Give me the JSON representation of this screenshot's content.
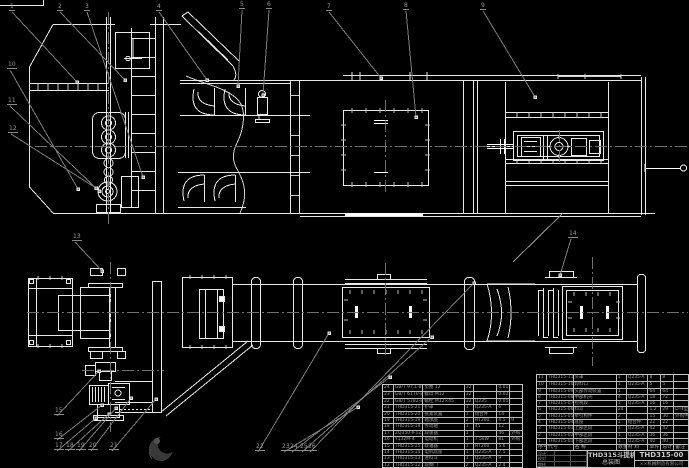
{
  "title_block": {
    "model": "THD315斗提机",
    "sheet_title": "总装图",
    "drawing_number": "THD315-00",
    "company": "××机械制造有限公司",
    "signature_labels": [
      "设计",
      "",
      "",
      "校对",
      "",
      "",
      "审核",
      "",
      ""
    ]
  },
  "colors": {
    "background": "#000000",
    "line": "#e8e8e8",
    "centerline": "#707070",
    "leader": "#7d7d7d",
    "table_text": "#a0a0a0"
  },
  "bom_right": {
    "headers": [
      "序号",
      "代号",
      "名 称",
      "数量",
      "材 料",
      "单件",
      "总计",
      "备注"
    ],
    "rows": [
      [
        "11",
        "THD315-11",
        "头罩",
        "1",
        "Q235-A",
        "8",
        "8",
        ""
      ],
      [
        "10",
        "THD315-10",
        "卸料口",
        "1",
        "Q235-A",
        "5",
        "5",
        ""
      ],
      [
        "9",
        "THD315-09",
        "头部传动装置",
        "1",
        "",
        "64",
        "64",
        ""
      ],
      [
        "8",
        "THD315-08",
        "中部机壳",
        "4",
        "Q235-A",
        "18",
        "72",
        ""
      ],
      [
        "7",
        "THD315-07",
        "检视段",
        "1",
        "Q235-A",
        "16",
        "16",
        ""
      ],
      [
        "6",
        "THD315-06",
        "料斗",
        "24",
        "",
        "1.2",
        "29",
        "DTⅡ型"
      ],
      [
        "5",
        "THD315-05",
        "牵引构件",
        "2",
        "",
        "15",
        "30",
        "外购件"
      ],
      [
        "4",
        "THD315-04",
        "底座",
        "1",
        "组合件",
        "22",
        "22",
        ""
      ],
      [
        "3",
        "THD315-03",
        "上部区段",
        "1",
        "Q235-A",
        "42",
        "42",
        ""
      ],
      [
        "2",
        "THD315-02",
        "中部区段",
        "1",
        "Q235-A",
        "36",
        "36",
        ""
      ],
      [
        "1",
        "THD315-01",
        "下部区段",
        "1",
        "Q235-A",
        "40",
        "40",
        ""
      ]
    ]
  },
  "bom_left": {
    "rows": [
      [
        "24",
        "GB/T 97.1-85",
        "垫圈 12",
        "32",
        "",
        "0.01",
        ""
      ],
      [
        "23",
        "GB/T 6170-86",
        "螺母 M12",
        "32",
        "",
        "0.02",
        ""
      ],
      [
        "22",
        "GB/T 5782-86",
        "螺栓 M12×45",
        "32",
        "Q235",
        "0.05",
        ""
      ],
      [
        "21",
        "THD315-21",
        "护罩",
        "1",
        "Q235-A",
        "6",
        ""
      ],
      [
        "20",
        "THD315-20",
        "张紧装置",
        "1",
        "组合件",
        "14",
        ""
      ],
      [
        "19",
        "THD315-19",
        "轴承座",
        "2",
        "HT200",
        "4.5",
        "9"
      ],
      [
        "18",
        "THD315-18",
        "传动轴",
        "1",
        "45",
        "12",
        ""
      ],
      [
        "17",
        "ZQ350-Ⅱ-1Z",
        "减速器",
        "1",
        "",
        "46",
        "外购"
      ],
      [
        "16",
        "Y132M-4",
        "电动机",
        "1",
        "7.5kW",
        "81",
        "外购"
      ],
      [
        "15",
        "THD315-15",
        "联轴器",
        "1",
        "HT200",
        "5.6",
        ""
      ],
      [
        "14",
        "THD315-14",
        "电机底座",
        "1",
        "Q235-A",
        "7.5",
        ""
      ],
      [
        "13",
        "THD315-13",
        "进料斗",
        "1",
        "Q235-A",
        "9",
        ""
      ],
      [
        "12",
        "THD315-12",
        "观察门",
        "2",
        "Q235-A",
        "2.4",
        ""
      ]
    ]
  },
  "callouts": [
    {
      "n": "1",
      "x": 9,
      "y": 4,
      "tx": 77,
      "ty": 82
    },
    {
      "n": "2",
      "x": 57,
      "y": 4,
      "tx": 125,
      "ty": 80
    },
    {
      "n": "3",
      "x": 84,
      "y": 4,
      "tx": 143,
      "ty": 177
    },
    {
      "n": "4",
      "x": 156,
      "y": 4,
      "tx": 207,
      "ty": 80
    },
    {
      "n": "5",
      "x": 239,
      "y": 2,
      "tx": 238,
      "ty": 86
    },
    {
      "n": "6",
      "x": 266,
      "y": 2,
      "tx": 263,
      "ty": 95
    },
    {
      "n": "7",
      "x": 326,
      "y": 4,
      "tx": 381,
      "ty": 78
    },
    {
      "n": "8",
      "x": 403,
      "y": 3,
      "tx": 416,
      "ty": 117
    },
    {
      "n": "9",
      "x": 480,
      "y": 3,
      "tx": 535,
      "ty": 97
    },
    {
      "n": "10",
      "x": 7,
      "y": 62,
      "tx": 78,
      "ty": 189
    },
    {
      "n": "11",
      "x": 7,
      "y": 98,
      "tx": 99,
      "ty": 191
    },
    {
      "n": "12",
      "x": 8,
      "y": 126,
      "tx": 96,
      "ty": 188
    },
    {
      "n": "13",
      "x": 72,
      "y": 234,
      "tx": 102,
      "ty": 271
    },
    {
      "n": "14",
      "x": 568,
      "y": 231,
      "tx": 560,
      "ty": 275
    },
    {
      "n": "15",
      "x": 54,
      "y": 408,
      "tx": 99,
      "ty": 371
    },
    {
      "n": "16",
      "x": 54,
      "y": 432,
      "tx": 102,
      "ty": 405
    },
    {
      "n": "17",
      "x": 54,
      "y": 443,
      "tx": 96,
      "ty": 418
    },
    {
      "n": "18",
      "x": 65,
      "y": 443,
      "tx": 109,
      "ty": 414
    },
    {
      "n": "19",
      "x": 76,
      "y": 443,
      "tx": 116,
      "ty": 408
    },
    {
      "n": "20",
      "x": 88,
      "y": 443,
      "tx": 131,
      "ty": 398
    },
    {
      "n": "21",
      "x": 109,
      "y": 443,
      "tx": 156,
      "ty": 399
    },
    {
      "n": "22",
      "x": 255,
      "y": 444,
      "tx": 329,
      "ty": 333
    },
    {
      "n": "23",
      "x": 281,
      "y": 444,
      "tx": 358,
      "ty": 407
    },
    {
      "n": "24",
      "x": 289,
      "y": 444,
      "tx": 390,
      "ty": 377
    },
    {
      "n": "25",
      "x": 299,
      "y": 444,
      "tx": 432,
      "ty": 337
    },
    {
      "n": "26",
      "x": 307,
      "y": 444,
      "tx": 474,
      "ty": 283
    }
  ]
}
